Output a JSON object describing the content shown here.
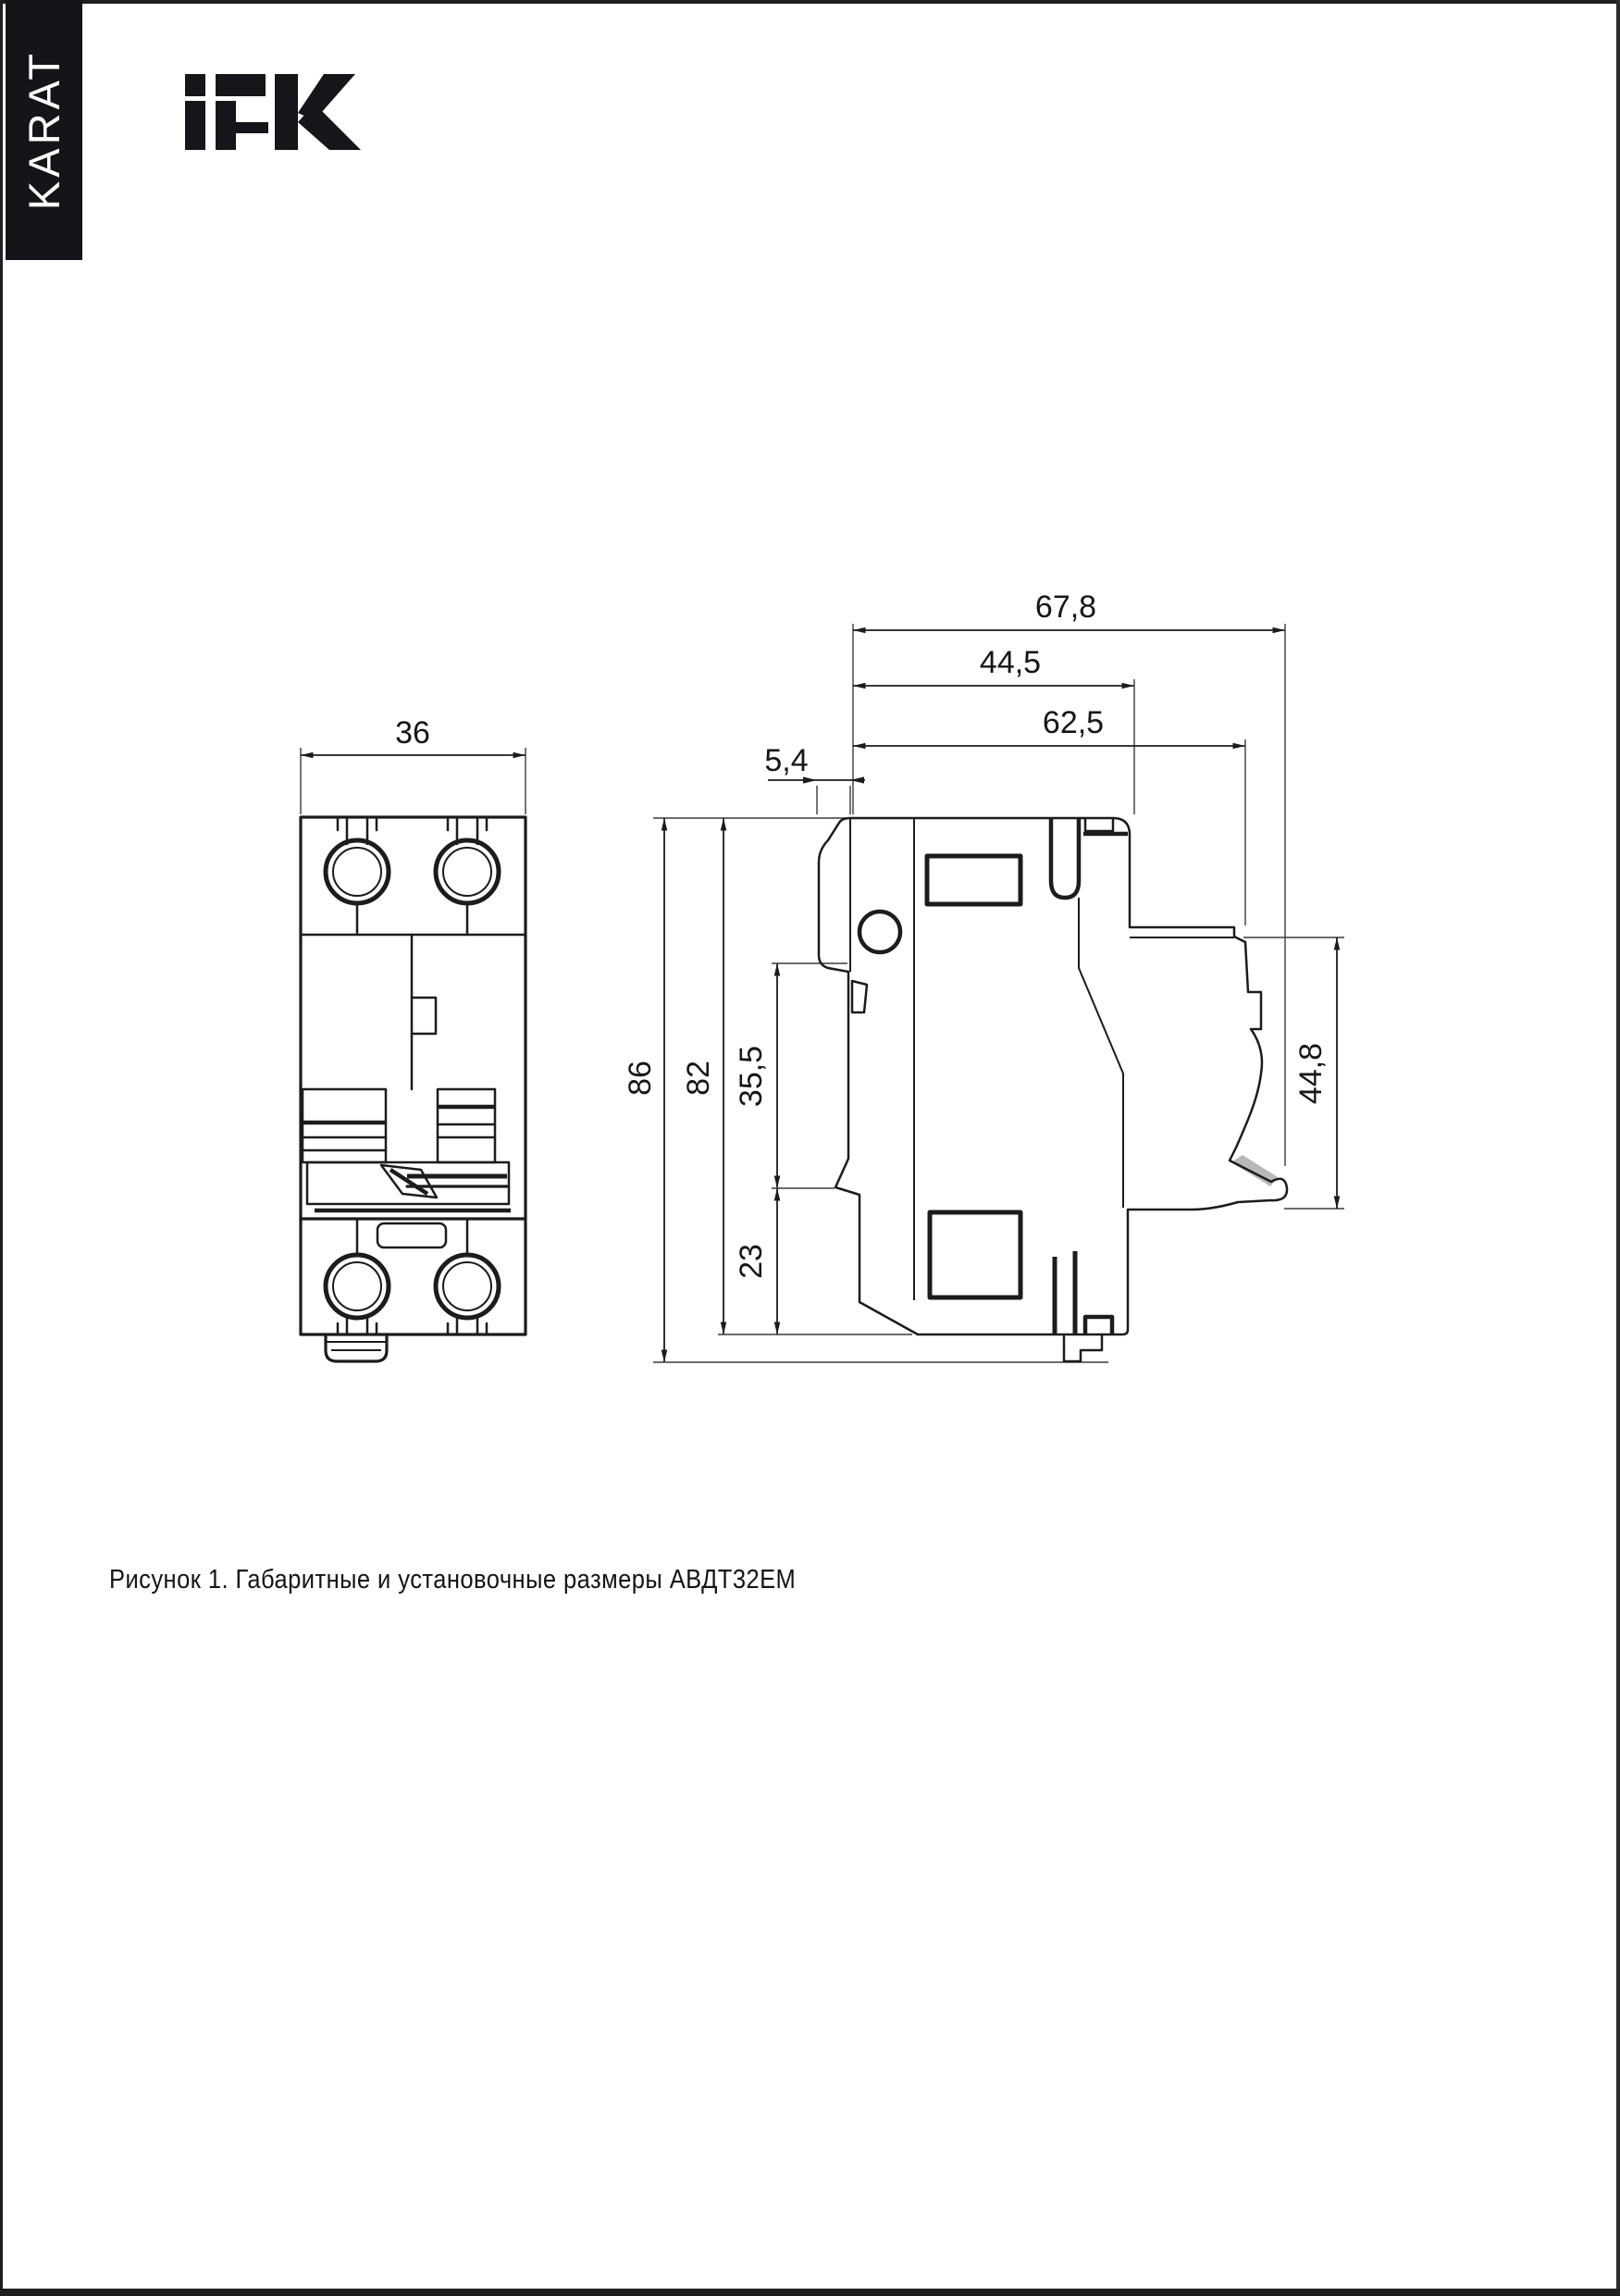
{
  "page": {
    "background": "#ffffff",
    "edge_color": "#1f1f1f"
  },
  "sidebar": {
    "label": "KARAT",
    "bg": "#161419",
    "text_color": "#ffffff"
  },
  "logo": {
    "name": "IEK",
    "color": "#17151a"
  },
  "drawing": {
    "caption": "Рисунок 1. Габаритные и установочные размеры АВДТ32ЕМ",
    "front_view": {
      "width": "36"
    },
    "side_view": {
      "overall_depth": "67,8",
      "upper_depth": "44,5",
      "rail_depth": "62,5",
      "handle_depth": "5,4",
      "overall_height": "86",
      "body_height": "82",
      "mid_height": "35,5",
      "lower_height": "23",
      "rail_height": "44,8"
    }
  }
}
